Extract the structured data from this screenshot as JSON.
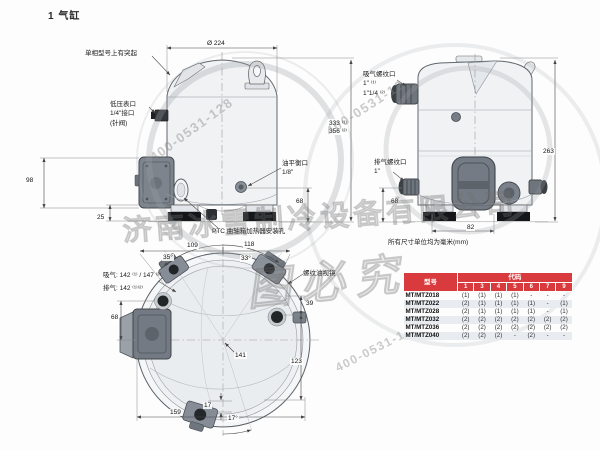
{
  "title": "1  气缸",
  "accent_color": "#d93a3d",
  "stripe_color": "#e8ebf0",
  "front_view": {
    "dim_diameter": "Ø 224",
    "label_protrusion": "单相型号上有突起",
    "label_low_pressure": "低压表口\n1/4\"接口\n(针阀)",
    "dim_height": "333 ⁽¹⁾\n356 ⁽²⁾",
    "label_suction": "吸气螺纹口\n1\" ⁽¹⁾\n1\"1/4 ⁽²⁾",
    "label_discharge": "排气螺纹口\n1\"",
    "label_oil_balance": "油平衡口\n1/8\"",
    "label_ptc": "PTC 曲轴箱加热器安装孔",
    "dim_98": "98",
    "dim_25": "25",
    "dim_68_left": "68",
    "dim_68_right": "68",
    "dim_263": "263",
    "dim_82": "82",
    "note_units": "所有尺寸单位均为毫米(mm)"
  },
  "top_view": {
    "dim_109": "109",
    "dim_118": "118",
    "angle_left": "35°",
    "angle_right": "33°",
    "label_sight_glass": "螺纹油视镜",
    "label_suction": "吸气: 142 ⁽¹⁾ / 147 ⁽²⁾",
    "label_discharge": "排气: 142 ⁽¹⁾⁽²⁾",
    "dim_68": "68",
    "dim_39": "39",
    "dim_141": "141",
    "dim_123": "123",
    "dim_159": "159",
    "dim_17": "17",
    "angle_port": "17°"
  },
  "table": {
    "header_model": "型号",
    "header_code": "代码",
    "code_columns": [
      "1",
      "3",
      "4",
      "5",
      "6",
      "7",
      "9"
    ],
    "rows": [
      {
        "model": "MT/MTZ018",
        "values": [
          "(1)",
          "(1)",
          "(1)",
          "(1)",
          "-",
          "-",
          "-"
        ]
      },
      {
        "model": "MT/MTZ022",
        "values": [
          "(2)",
          "(1)",
          "(1)",
          "(1)",
          "(1)",
          "-",
          "(1)"
        ]
      },
      {
        "model": "MT/MTZ028",
        "values": [
          "(2)",
          "(1)",
          "(1)",
          "(1)",
          "(1)",
          "-",
          "(1)"
        ]
      },
      {
        "model": "MT/MTZ032",
        "values": [
          "(2)",
          "(2)",
          "(2)",
          "(2)",
          "(2)",
          "(2)",
          "(2)"
        ]
      },
      {
        "model": "MT/MTZ036",
        "values": [
          "(2)",
          "(2)",
          "(2)",
          "(2)",
          "(2)",
          "(2)",
          "(2)"
        ]
      },
      {
        "model": "MT/MTZ040",
        "values": [
          "(2)",
          "(2)",
          "(2)",
          "-",
          "(2)",
          "-",
          "-"
        ]
      }
    ]
  },
  "watermarks": {
    "company": "济南冰雪制冷设备有限公司",
    "slogan": "图必究",
    "phone1": "400-0531-128",
    "phone2": "400-0531-12",
    "phone3": "400-0531-1"
  }
}
